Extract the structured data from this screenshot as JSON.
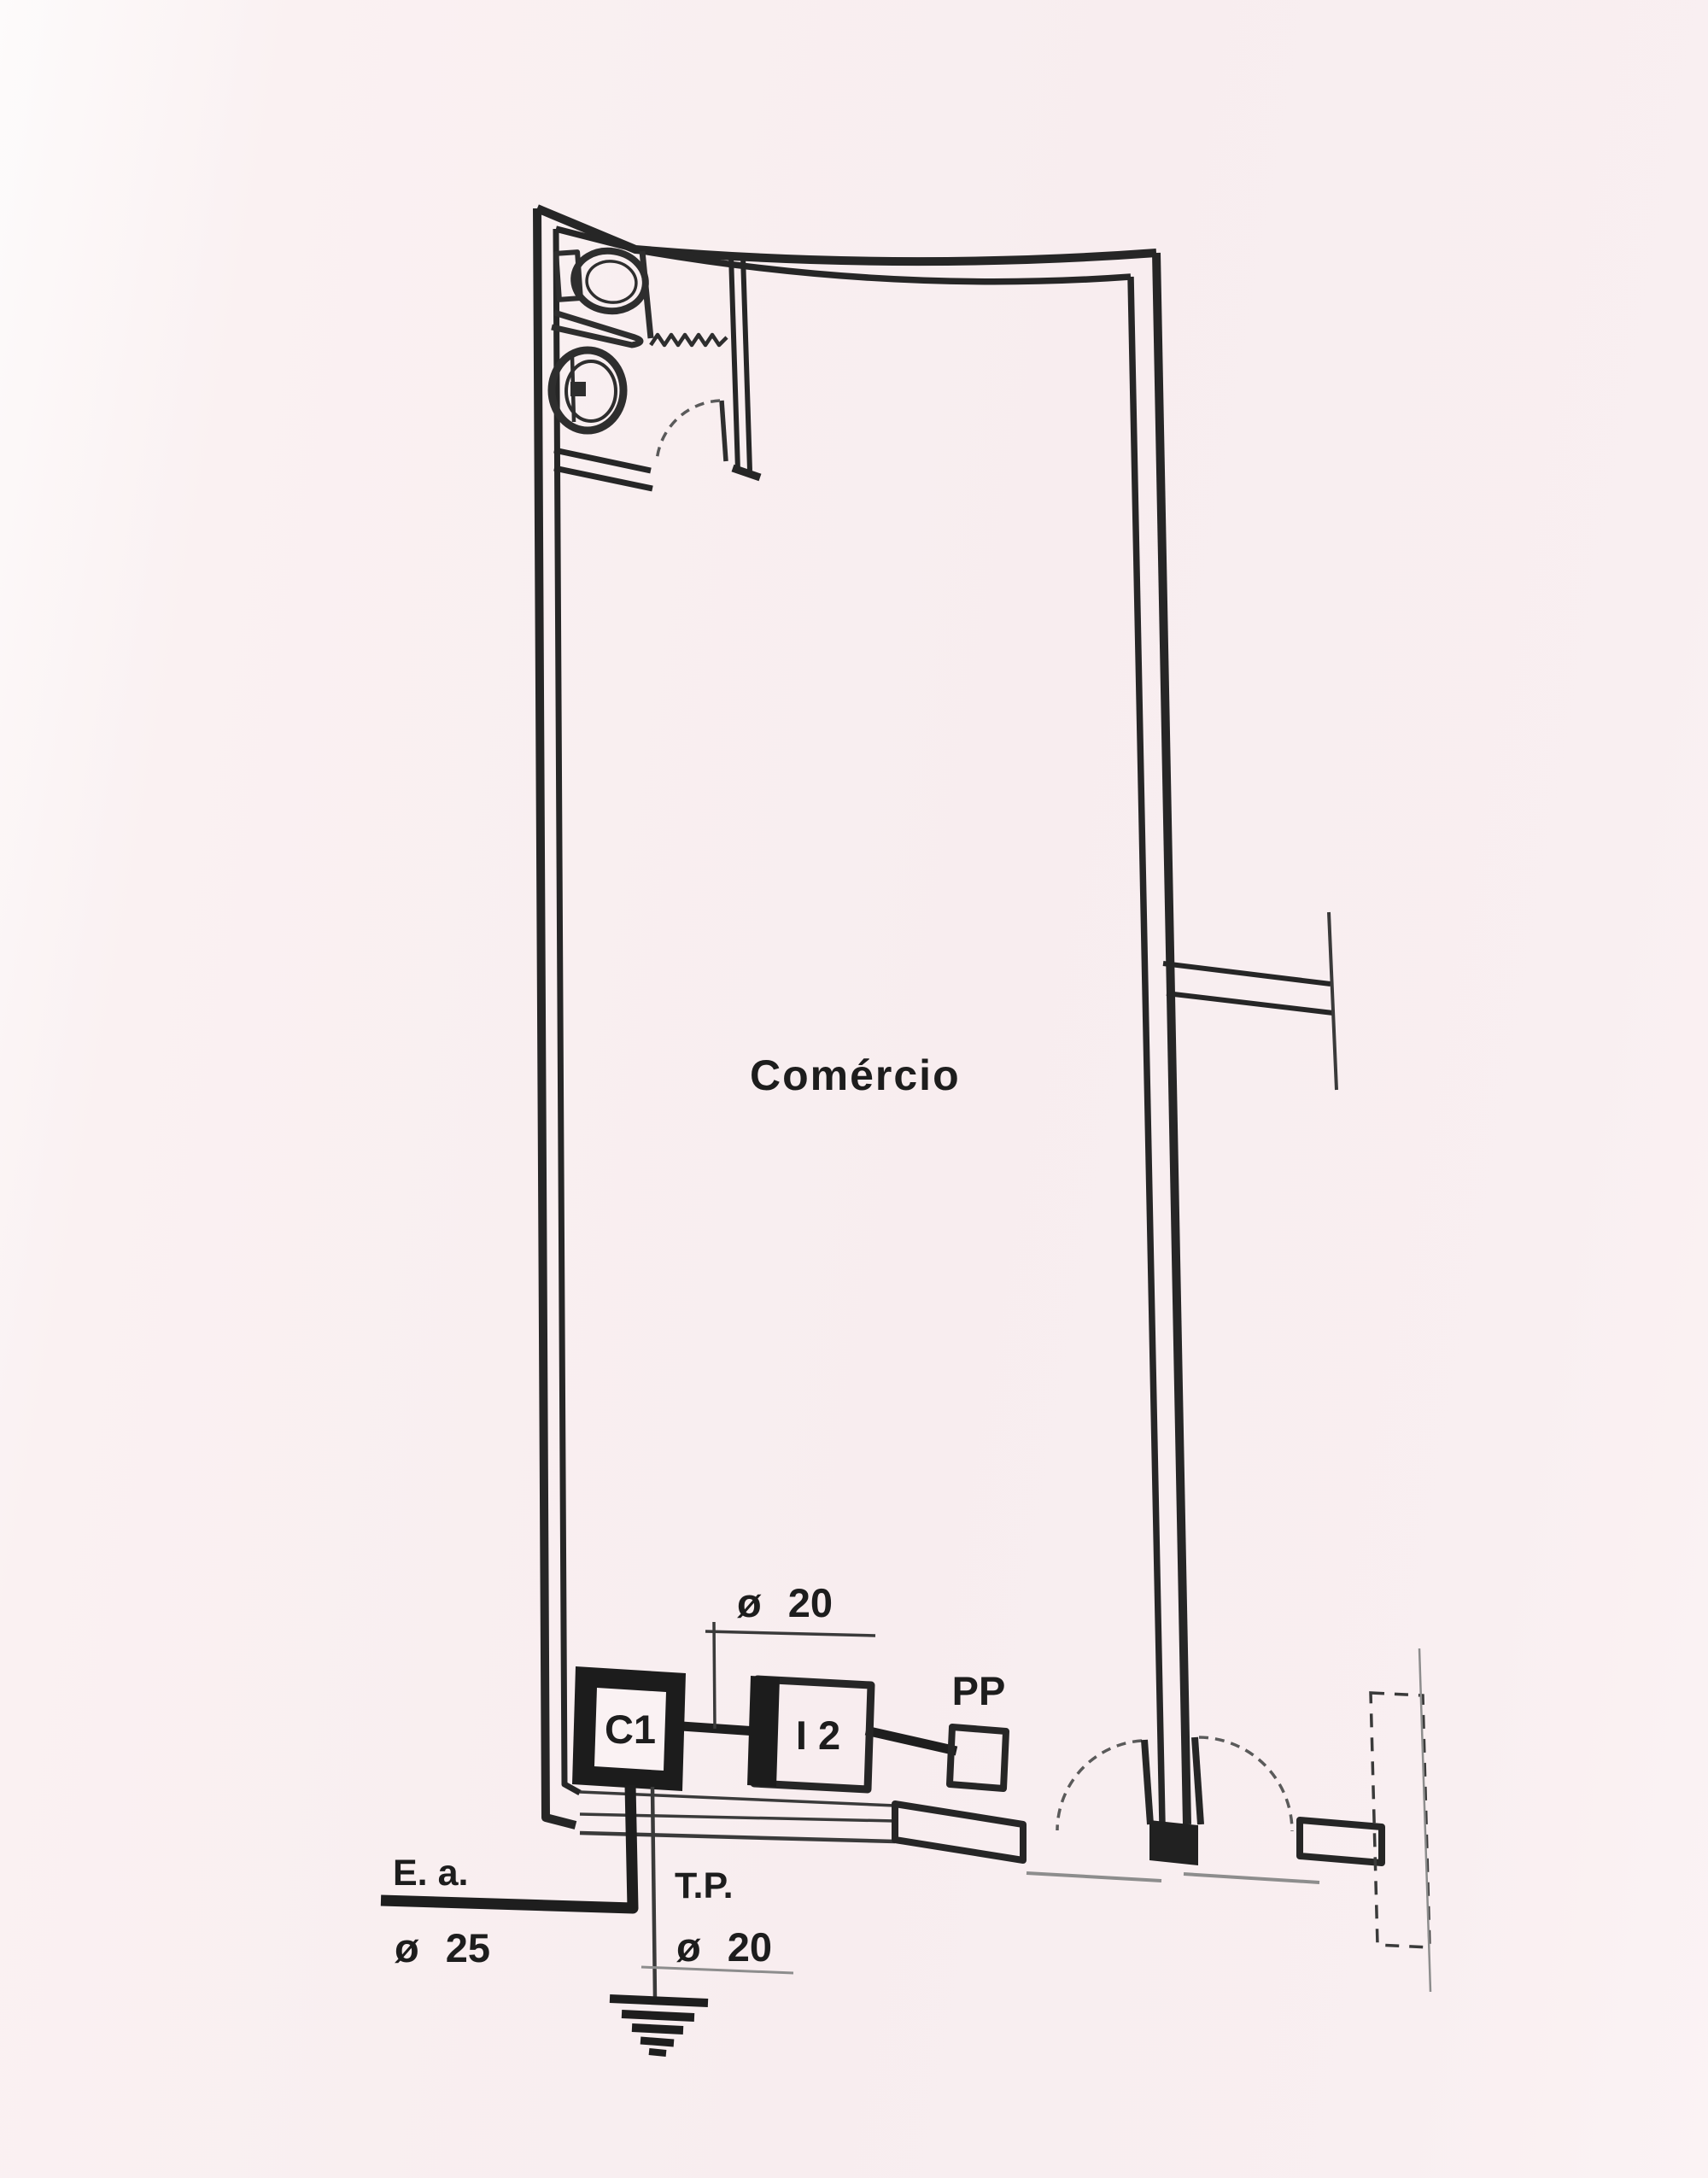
{
  "plan": {
    "room_label": "Comércio",
    "circuit_dimension": "ø 20",
    "equipment": {
      "c1": "C1",
      "i2": "I 2",
      "pp": "PP"
    },
    "feeders": {
      "ea_label": "E. a.",
      "ea_diameter": "ø 25",
      "tp_label": "T.P.",
      "tp_diameter": "ø 20"
    },
    "colors": {
      "ink": "#262626",
      "paper_tint": "#f8edef"
    }
  }
}
